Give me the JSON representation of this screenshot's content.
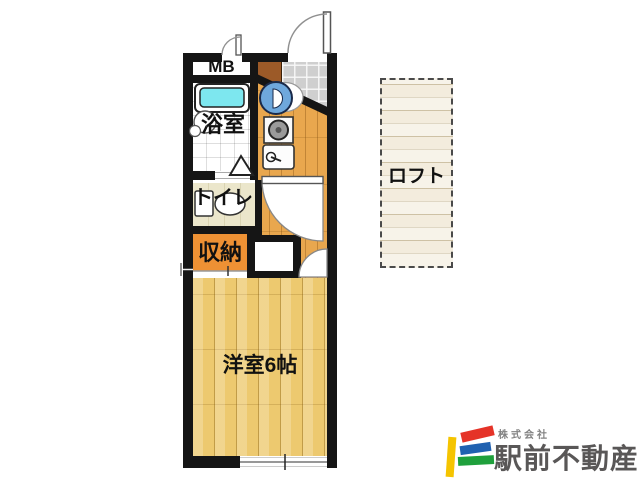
{
  "floorplan": {
    "rooms": {
      "meter_box": {
        "label": "MB"
      },
      "bathroom": {
        "label": "浴室"
      },
      "toilet": {
        "label": "トイレ"
      },
      "storage": {
        "label": "収納"
      },
      "main_room": {
        "label": "洋室6帖"
      },
      "loft": {
        "label": "ロフト"
      }
    },
    "colors": {
      "wall": "#151515",
      "main_room_floor": "#edc96f",
      "kitchen_floor": "#e9a74e",
      "storage_fill": "#ee9134",
      "bathtub": "#7de7ef",
      "washing_machine": "#6fa8dc",
      "toilet_floor": "#ebe6cb",
      "genkan_tile": "#cfcfcf",
      "shoe_cabinet": "#9c5a28",
      "loft_floor": "#f3ecdd"
    }
  },
  "logo": {
    "company_prefix": "株式会社",
    "company_name": "駅前不動産",
    "text_color": "#595757",
    "mark_colors": {
      "yellow": "#f5c400",
      "red": "#e53328",
      "blue": "#2061b0",
      "green": "#1fa03c"
    }
  }
}
